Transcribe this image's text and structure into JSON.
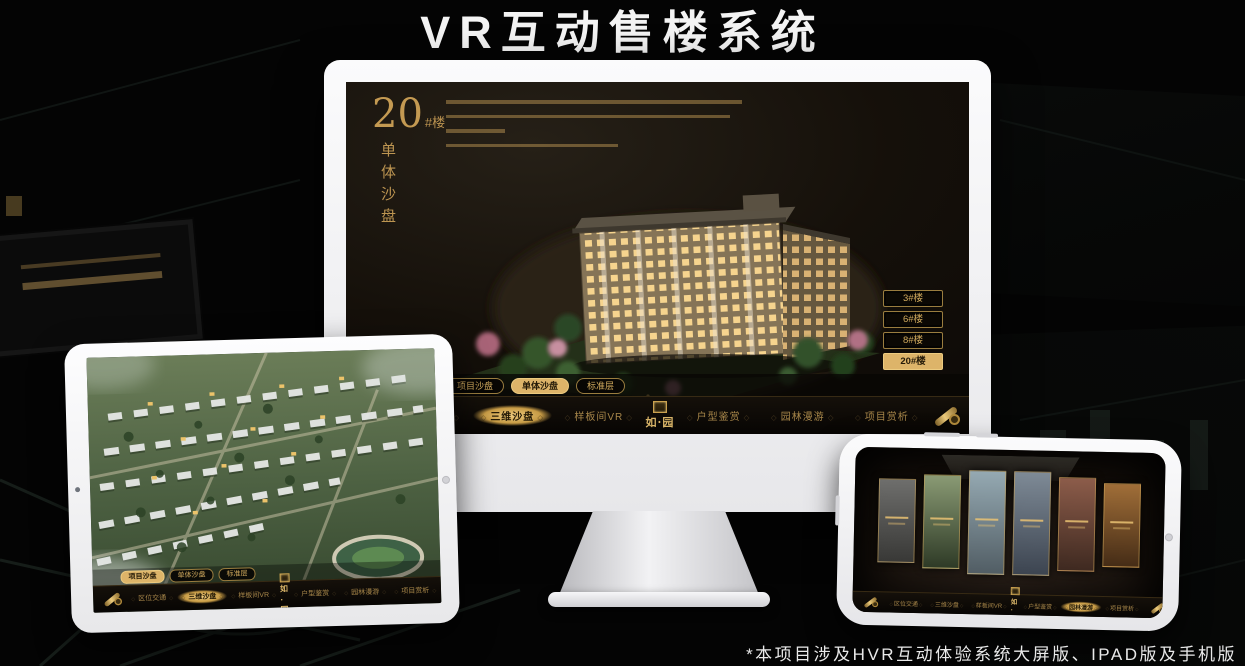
{
  "header": {
    "title": "VR互动售楼系统"
  },
  "footer": {
    "note": "*本项目涉及HVR互动体验系统大屏版、IPAD版及手机版"
  },
  "colors": {
    "gold": "#d2ab5e",
    "gold_active": "#ddb469",
    "screen_bg": "#15100a",
    "title_text": "#f4f4f4"
  },
  "nav": {
    "logo_text": "如·园",
    "items": [
      "区位交通",
      "三维沙盘",
      "样板间VR",
      "户型鉴赏",
      "园林漫游",
      "项目赏析"
    ]
  },
  "subtabs": [
    "项目沙盘",
    "单体沙盘",
    "标准层"
  ],
  "monitor": {
    "panel": {
      "number": "20",
      "suffix": "#楼",
      "subtitle": "单体沙盘"
    },
    "buildings": [
      "3#楼",
      "6#楼",
      "8#楼",
      "20#楼"
    ],
    "active_building": "20#楼",
    "active_subtab": "单体沙盘",
    "active_nav": "三维沙盘"
  },
  "tablet": {
    "active_subtab": "项目沙盘",
    "active_nav": "三维沙盘"
  },
  "phone": {
    "active_nav": "园林漫游",
    "gallery_panels": 6
  }
}
